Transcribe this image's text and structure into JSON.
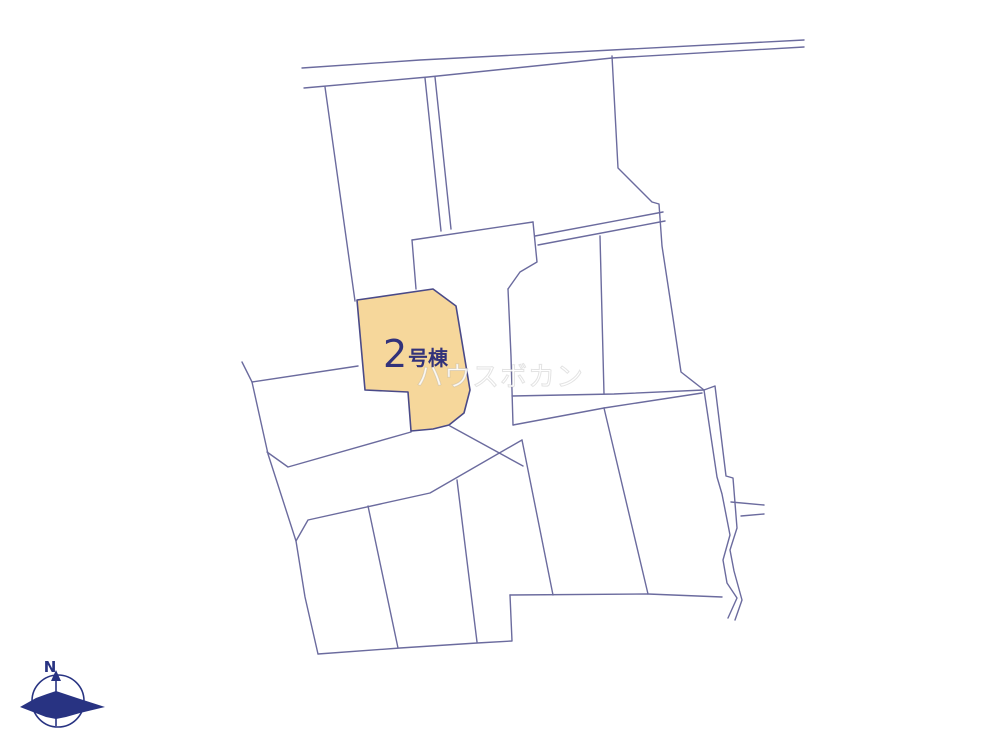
{
  "map": {
    "highlighted_parcel": {
      "number": "2",
      "suffix": "号棟",
      "label": "2号棟"
    },
    "watermark_text": "ハウスボカン",
    "compass": {
      "north_label": "N"
    }
  },
  "colors": {
    "background": "#ffffff",
    "boundary_line": "#6b6b9e",
    "highlight_fill": "#f6d79b",
    "highlight_stroke": "#4a4a88",
    "label_text": "#32327a",
    "watermark": "#ffffff",
    "compass": "#283382"
  }
}
